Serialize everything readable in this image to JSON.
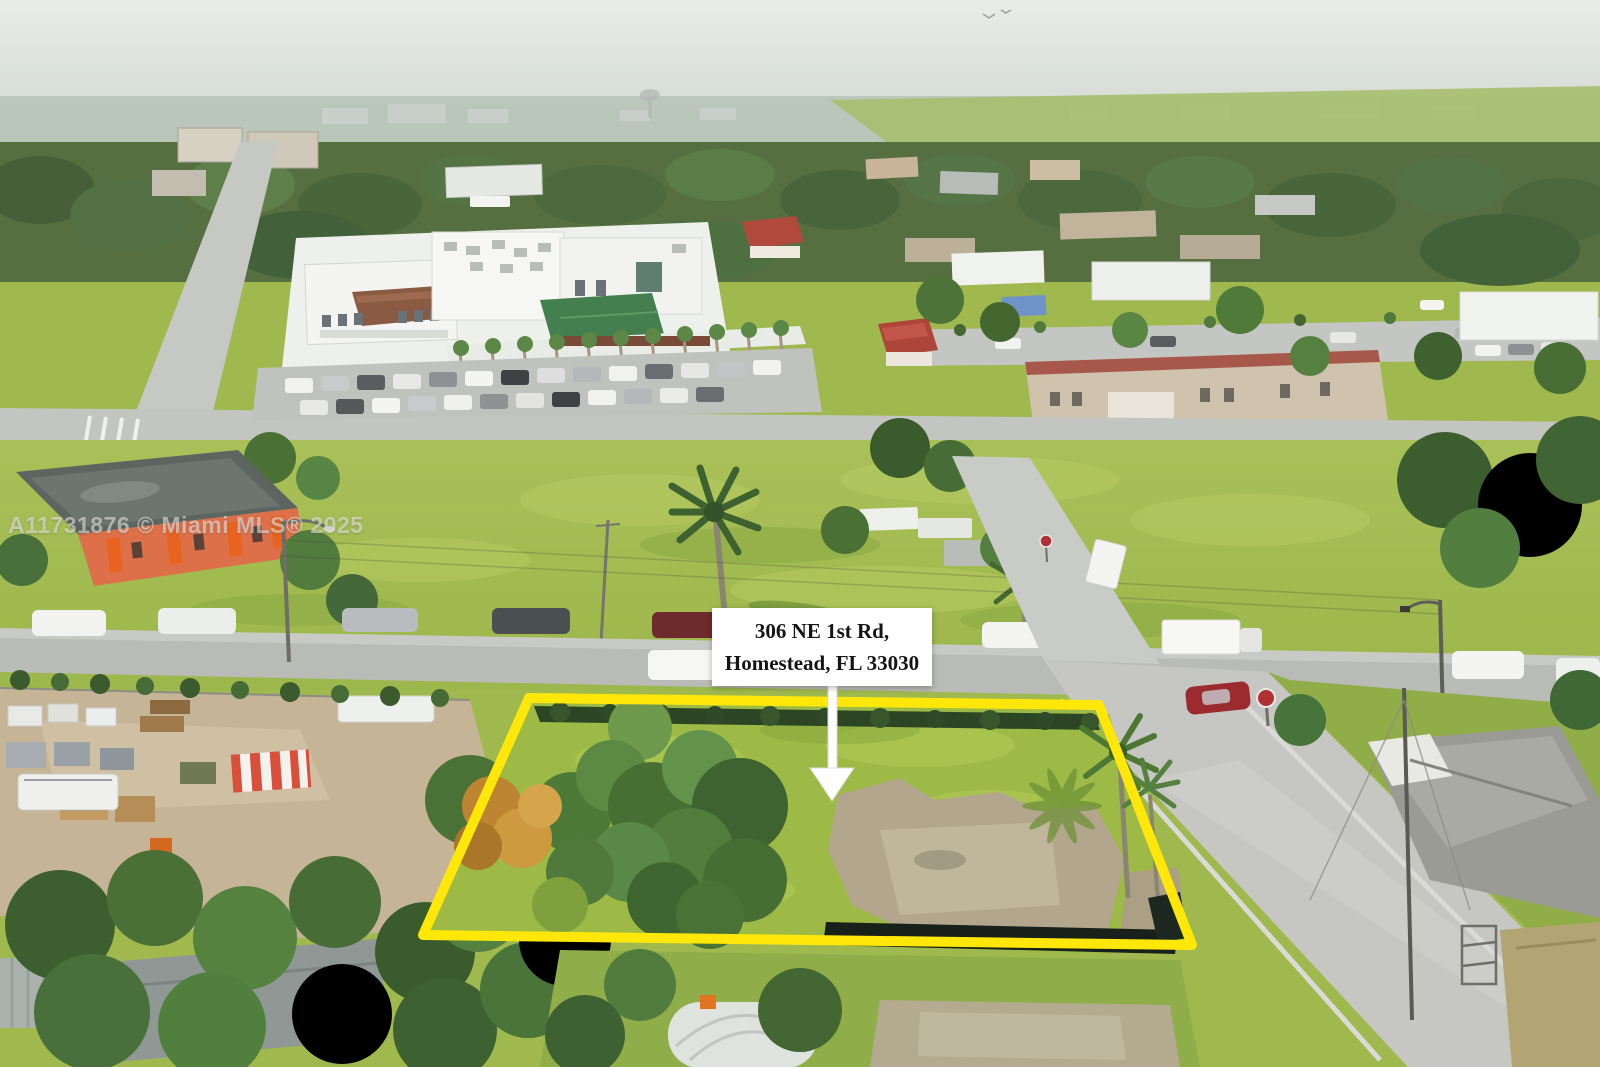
{
  "listing": {
    "watermark": "A11731876 © Miami MLS® 2025",
    "address_label": {
      "line1": "306 NE 1st Rd,",
      "line2": "Homestead, FL 33030"
    }
  },
  "colors": {
    "lot_outline": "#ffe70a",
    "label_background": "#ffffff",
    "label_text": "#141414",
    "arrow": "#ffffff",
    "watermark_text": "rgba(238,238,238,0.55)"
  }
}
